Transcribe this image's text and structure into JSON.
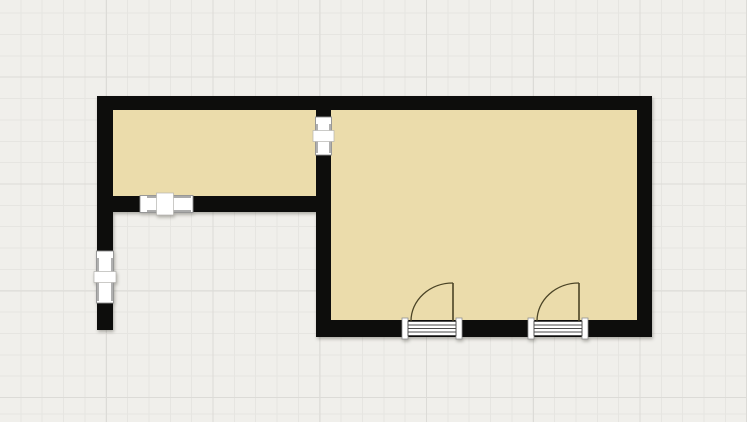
{
  "canvas": {
    "width": 747,
    "height": 422,
    "background_color": "#f0efeb",
    "grid": {
      "minor_spacing": 21.35,
      "major_spacing": 106.75,
      "minor_color": "#e6e5e1",
      "major_color": "#dcdbd7"
    }
  },
  "floorplan": {
    "colors": {
      "wall": "#0d0d0c",
      "floor": "#ebdcab",
      "door_stroke": "#4b4426",
      "sill_line": "#4a4a4a",
      "fixture_fill": "#ffffff",
      "fixture_border": "#8f8f8f"
    },
    "rooms": [
      {
        "name": "room-floor-left",
        "x": 113,
        "y": 110,
        "w": 203,
        "h": 86
      },
      {
        "name": "room-floor-right",
        "x": 331,
        "y": 110,
        "w": 306,
        "h": 210
      }
    ],
    "walls": [
      {
        "name": "wall-top",
        "x": 97,
        "y": 96,
        "w": 555,
        "h": 14
      },
      {
        "name": "wall-left",
        "x": 97,
        "y": 96,
        "w": 16,
        "h": 234
      },
      {
        "name": "wall-interior-vertical",
        "x": 316,
        "y": 96,
        "w": 15,
        "h": 241
      },
      {
        "name": "wall-right",
        "x": 637,
        "y": 96,
        "w": 15,
        "h": 241
      },
      {
        "name": "wall-left-room-bottom",
        "x": 97,
        "y": 196,
        "w": 234,
        "h": 16
      },
      {
        "name": "wall-right-room-bottom",
        "x": 316,
        "y": 320,
        "w": 336,
        "h": 17
      }
    ],
    "windows": [
      {
        "name": "window-interior-wall",
        "orientation": "vertical",
        "wall_x": 316,
        "wall_w": 15,
        "y": 117,
        "h": 38
      },
      {
        "name": "window-left-room-south",
        "orientation": "horizontal",
        "wall_y": 196,
        "wall_h": 16,
        "x": 140,
        "w": 53
      },
      {
        "name": "window-left-wall",
        "orientation": "vertical",
        "wall_x": 97,
        "wall_w": 16,
        "y": 251,
        "h": 52
      }
    ],
    "doors": [
      {
        "name": "door-1",
        "opening_x": 402,
        "opening_w": 60,
        "wall_y": 320,
        "wall_h": 17,
        "jamb_w": 6,
        "leaf_x": 453,
        "leaf_top": 283,
        "swing_end_x": 411
      },
      {
        "name": "door-2",
        "opening_x": 528,
        "opening_w": 60,
        "wall_y": 320,
        "wall_h": 17,
        "jamb_w": 6,
        "leaf_x": 579,
        "leaf_top": 283,
        "swing_end_x": 537
      }
    ]
  }
}
